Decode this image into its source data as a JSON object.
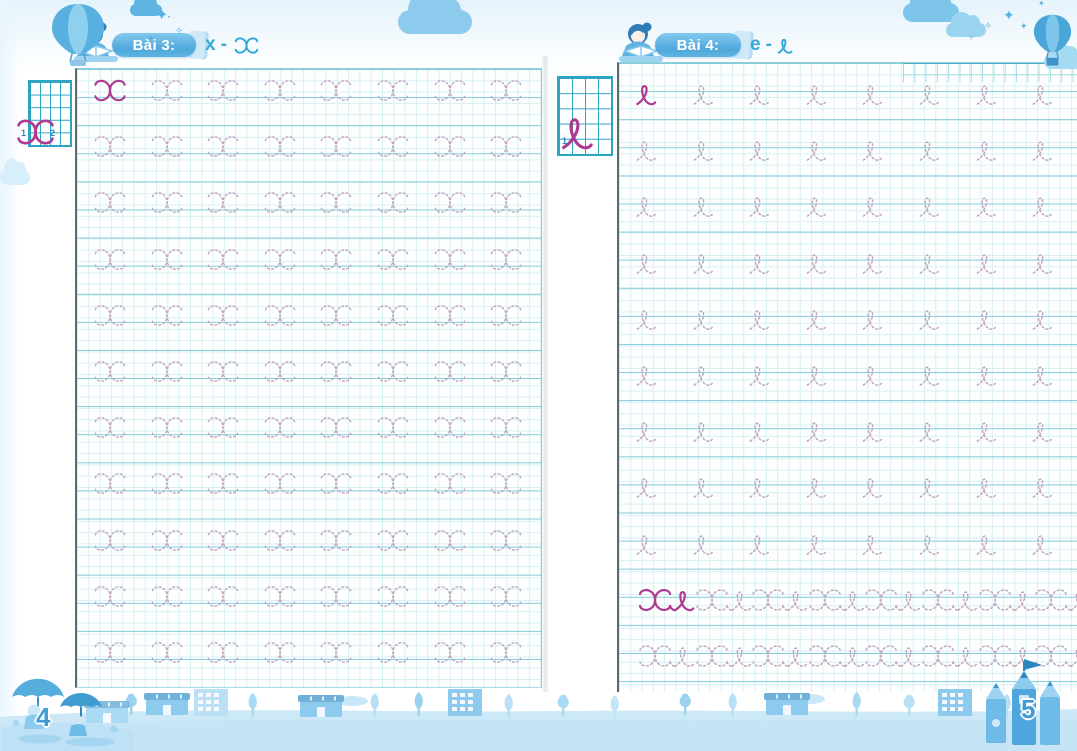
{
  "book": {
    "width": 1077,
    "height": 751,
    "type": "handwriting-practice-workbook"
  },
  "pages": [
    {
      "side": "left",
      "page_number": "4",
      "header": {
        "lesson_label": "Bài 3:",
        "pair_print": "x",
        "pair_dash": "-",
        "pair_cursive_glyph": "x"
      },
      "example": {
        "glyph": "x",
        "stroke_numbers": [
          "1",
          "2"
        ]
      },
      "practice": {
        "per_row": 8,
        "groups": [
          {
            "glyph": "x",
            "rows": 11,
            "first_solid": true
          }
        ]
      }
    },
    {
      "side": "right",
      "page_number": "5",
      "header": {
        "lesson_label": "Bài 4:",
        "pair_print": "e",
        "pair_dash": "-",
        "pair_cursive_glyph": "e"
      },
      "example": {
        "glyph": "e",
        "stroke_numbers": [
          "1"
        ]
      },
      "practice": {
        "per_row": 8,
        "groups": [
          {
            "glyph": "e",
            "rows": 9,
            "first_solid": true
          },
          {
            "glyph": "xe",
            "rows": 2,
            "first_solid": true
          }
        ]
      }
    }
  ],
  "icons": {
    "star": "✦",
    "star_outline": "✧",
    "dot": "•",
    "flag": "▶"
  },
  "colors": {
    "letter_solid_magenta": "#ae3a91",
    "letter_trace_pink": "#bfa0bb",
    "grid_fine": "#d7eff4",
    "grid_strong": "#84cbd9",
    "grid_border_dark": "#5b6a70",
    "example_grid_teal": "#2fa3c2",
    "banner_blue": "#4fa8db",
    "pair_text_blue": "#35a9d6",
    "decor_blue_light": "#b9e0f6",
    "decor_blue_mid": "#8ccbee",
    "decor_blue_dark": "#4aa0d4",
    "page_number_blue": "#3e9bd4"
  },
  "decorations": {
    "top_left": [
      "hot-air-balloon-icon",
      "cloud-icon",
      "stars-icon"
    ],
    "top_middle": [
      "cloud-icon"
    ],
    "top_right": [
      "cloud-icon",
      "stars-icon",
      "hot-air-balloon-icon"
    ],
    "bottom": [
      "children-umbrellas-icon",
      "town-houses-icon",
      "trees-icon",
      "pencil-castle-icon",
      "flag-icon"
    ]
  }
}
